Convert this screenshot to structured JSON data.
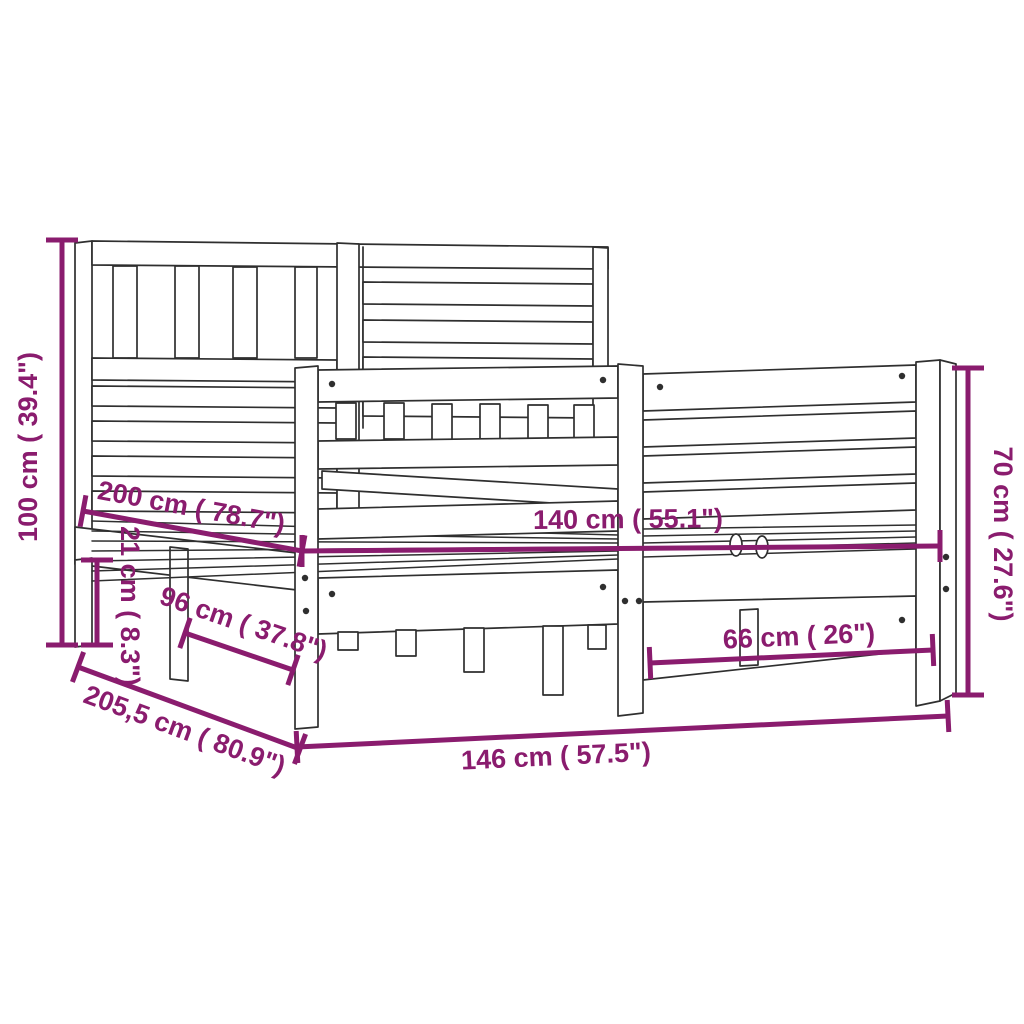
{
  "diagram": {
    "subject": "wooden bed frame with headboard - dimension drawing",
    "background": "#ffffff",
    "line_color": "#2f2f2f",
    "dimension_color": "#8a1c6e",
    "dimensions": {
      "headboard_height": {
        "label": "100 cm ( 39.4\")",
        "cm": "100",
        "inches": "39.4",
        "orientation": "vertical-left"
      },
      "mattress_length": {
        "label": "200 cm ( 78.7\")",
        "cm": "200",
        "inches": "78.7",
        "orientation": "diagonal-depth"
      },
      "floor_clearance": {
        "label": "21 cm ( 8.3\")",
        "cm": "21",
        "inches": "8.3",
        "orientation": "vertical-small"
      },
      "support_depth": {
        "label": "96 cm ( 37.8\")",
        "cm": "96",
        "inches": "37.8",
        "orientation": "diagonal-depth"
      },
      "total_length": {
        "label": "205,5 cm ( 80.9\")",
        "cm": "205,5",
        "inches": "80.9",
        "orientation": "diagonal-depth"
      },
      "total_width": {
        "label": "146 cm ( 57.5\")",
        "cm": "146",
        "inches": "57.5",
        "orientation": "horizontal-bottom"
      },
      "mattress_width": {
        "label": "140 cm ( 55.1\")",
        "cm": "140",
        "inches": "55.1",
        "orientation": "horizontal-middle"
      },
      "footboard_span": {
        "label": "66 cm ( 26\")",
        "cm": "66",
        "inches": "26",
        "orientation": "horizontal-right"
      },
      "footboard_height": {
        "label": "70 cm ( 27.6\")",
        "cm": "70",
        "inches": "27.6",
        "orientation": "vertical-right"
      }
    }
  }
}
